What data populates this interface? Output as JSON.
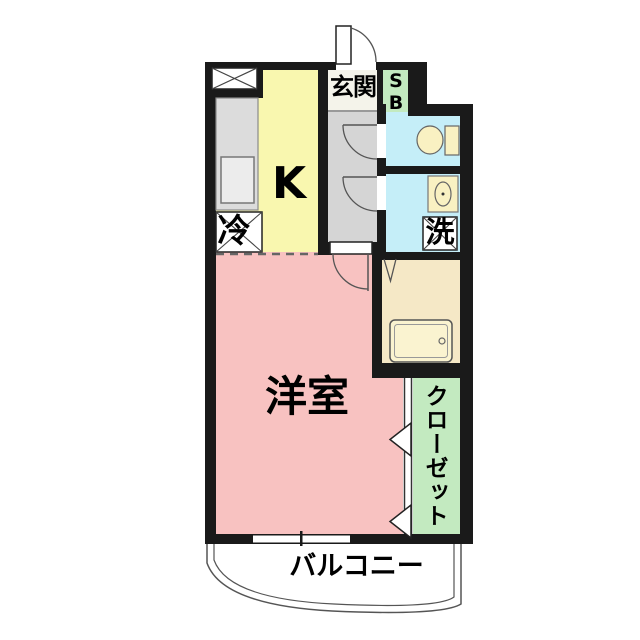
{
  "plan": {
    "labels": {
      "entrance": "玄関",
      "shoe_box": "SB",
      "kitchen": "K",
      "refrigerator": "冷",
      "washer": "洗",
      "western_room": "洋室",
      "closet": "クローゼット",
      "balcony": "バルコニー"
    },
    "colors": {
      "wall": "#1a1a1a",
      "kitchen_floor": "#f9f7af",
      "room_floor": "#f8c2c1",
      "wet_floor": "#c5eef8",
      "green_zone": "#c3eac0",
      "bath_floor": "#f5e8c6",
      "hall_floor": "#d5d5d5",
      "entrance_floor": "#f4f3ea",
      "counter": "#dcdcdc",
      "fixture": "#f9f1c2"
    }
  }
}
